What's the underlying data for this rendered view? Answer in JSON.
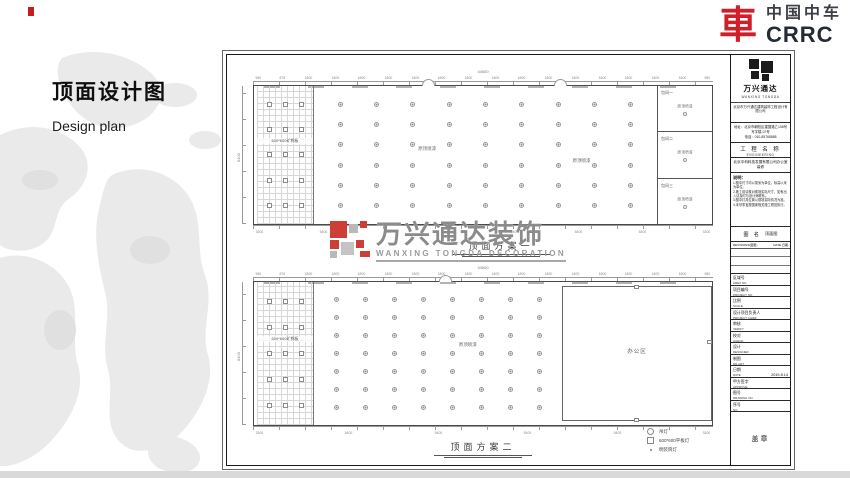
{
  "page": {
    "title": "顶面设计图",
    "subtitle": "Design plan"
  },
  "brand": {
    "emblem_char": "車",
    "name_cn": "中国中车",
    "name_en": "CRRC",
    "red": "#d01f2a"
  },
  "watermark": {
    "cn": "万兴通达装饰",
    "en": "WANXING TONGDA DECORATION"
  },
  "plans": [
    {
      "caption": "顶面方案一",
      "total_dim": "44500",
      "side_dim": "8400",
      "grid_label": "600*600矿棉板",
      "area_label_1": "原顶喷漆",
      "area_label_2": "原顶喷漆",
      "rooms": [
        {
          "name": "包间一",
          "ceiling": "原顶喷漆"
        },
        {
          "name": "包间二",
          "ceiling": "原顶喷漆"
        },
        {
          "name": "包间三",
          "ceiling": "原顶喷漆"
        }
      ],
      "dims_top": [
        "980",
        "875",
        "1800",
        "1800",
        "1800",
        "1800",
        "1800",
        "1800",
        "1800",
        "1800",
        "1800",
        "1800",
        "1800",
        "1800",
        "1800",
        "1800",
        "1800",
        "980"
      ],
      "dims_bottom": [
        "3300",
        "5400",
        "5400",
        "5400",
        "5400",
        "5400",
        "5400",
        "3300"
      ],
      "lights": {
        "rows": 6,
        "cols": 9
      },
      "panels": {
        "rows": 5,
        "cols": 3
      }
    },
    {
      "caption": "顶面方案二",
      "total_dim": "44500",
      "side_dim": "8400",
      "grid_label": "600*600矿棉板",
      "area_label_1": "原顶喷漆",
      "office_label": "办公区",
      "dims_top": [
        "980",
        "875",
        "1800",
        "1800",
        "1800",
        "1800",
        "1800",
        "1800",
        "1800",
        "1800",
        "1800",
        "1800",
        "1800",
        "1800",
        "1800",
        "1800",
        "1800",
        "980"
      ],
      "dims_bottom": [
        "3300",
        "5400",
        "5400",
        "5400",
        "5400",
        "3300"
      ],
      "lights": {
        "rows": 7,
        "cols": 8
      },
      "panels": {
        "rows": 5,
        "cols": 3
      }
    }
  ],
  "legend": {
    "items": [
      {
        "type": "circle",
        "label": "吊灯"
      },
      {
        "type": "square",
        "label": "600*600平板灯"
      },
      {
        "type": "dot",
        "label": "明装筒灯"
      }
    ]
  },
  "titleblock": {
    "logo_cn": "万兴通达",
    "logo_en": "WANXING TONGDA",
    "company": "北京市万兴通达建筑装饰工程设计有限公司",
    "address_line1": "地址：北京市朝阳区建国路乙108号写字楼-07号",
    "address_line2": "电话：010-85768888",
    "eng_cn": "工 程 名 称",
    "eng_en": "ENGINEERING",
    "project": "北京中科科技发展有限公司办公室装修",
    "notes_title": "说明：",
    "notes": [
      "1.图中尺寸均以毫米为单位，标高以米为单位。",
      "2.施工前请核对现场实际尺寸，如有出入请及时与设计师联系。",
      "3.图中灯具位置以现场实际情况为准。",
      "4.未尽事宜按国家相关施工规范执行。"
    ],
    "dname_cn": "图 名",
    "dname_value": "顶面图",
    "rev_left": "REVISIONS(图更)",
    "rev_right": "DATE 日期",
    "fields": [
      {
        "cn": "区域号",
        "en": "AREA NO",
        "value": ""
      },
      {
        "cn": "项目编号",
        "en": "PROJECT NO",
        "value": ""
      },
      {
        "cn": "比例",
        "en": "SCALE",
        "value": ""
      },
      {
        "cn": "设计项目负责人",
        "en": "PROJECT CHIEF",
        "value": ""
      },
      {
        "cn": "审核",
        "en": "VERIFY",
        "value": ""
      },
      {
        "cn": "校对",
        "en": "CHECK",
        "value": ""
      },
      {
        "cn": "设计",
        "en": "DESIGNER",
        "value": ""
      },
      {
        "cn": "制图",
        "en": "DR.ART",
        "value": ""
      },
      {
        "cn": "日期",
        "en": "DATE",
        "value": "2019.8.14"
      },
      {
        "cn": "甲方签字",
        "en": "APPROVE",
        "value": ""
      },
      {
        "cn": "图号",
        "en": "DRAWING NO",
        "value": ""
      },
      {
        "cn": "序号",
        "en": "NO",
        "value": ""
      }
    ],
    "stamp": "盖章"
  }
}
